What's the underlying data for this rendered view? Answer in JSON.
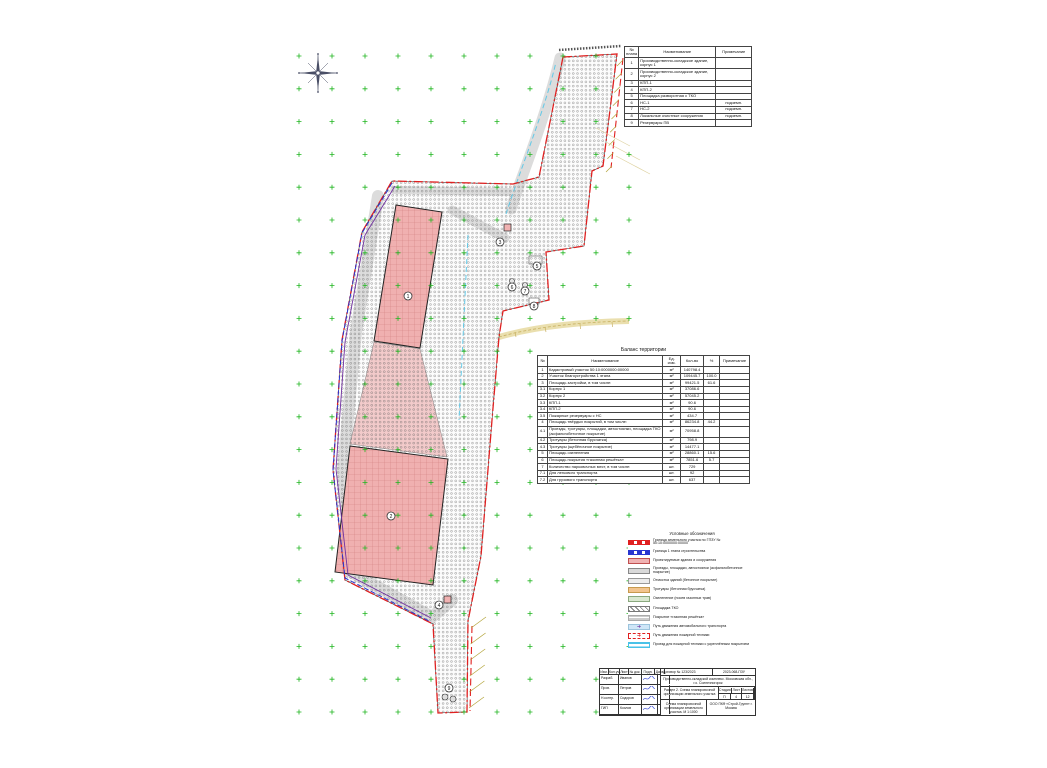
{
  "sheet": {
    "kind": "Схема планировочной организации земельного участка"
  },
  "buildings_table": {
    "headers": [
      "№ плана",
      "Наименование",
      "Примечание"
    ],
    "rows": [
      [
        "1",
        "Производственно-складское здание, корпус 1",
        ""
      ],
      [
        "2",
        "Производственно-складское здание, корпус 2",
        ""
      ],
      [
        "3",
        "КПП-1",
        ""
      ],
      [
        "4",
        "КПП-2",
        ""
      ],
      [
        "5",
        "Площадка разворотная с ТКО",
        ""
      ],
      [
        "6",
        "НС-1",
        "подземн."
      ],
      [
        "7",
        "НС-2",
        "подземн."
      ],
      [
        "8",
        "Локальные очистные сооружения",
        "подземн."
      ],
      [
        "9",
        "Резервуары ПВ",
        ""
      ]
    ]
  },
  "balance_table": {
    "title": "Баланс территории",
    "headers": [
      "№",
      "Наименование",
      "Ед. изм.",
      "Кол-во",
      "%",
      "Примечание"
    ],
    "rows": [
      [
        "1",
        "Кадастровый участок 50:10:0000000:00000",
        "м²",
        "140798.4",
        "",
        ""
      ],
      [
        "2",
        "Участок благоустройства 1 этапа",
        "м²",
        "109445.7",
        "100.0",
        ""
      ],
      [
        "3",
        "Площадь застройки, в том числе:",
        "м²",
        "99421.5",
        "61.6",
        ""
      ],
      [
        "3.1",
        "Корпус 1",
        "м²",
        "37086.6",
        "",
        ""
      ],
      [
        "3.2",
        "Корпус 2",
        "м²",
        "57045.2",
        "",
        ""
      ],
      [
        "3.3",
        "КПП-1",
        "м²",
        "90.6",
        "",
        ""
      ],
      [
        "3.4",
        "КПП-2",
        "м²",
        "90.6",
        "",
        ""
      ],
      [
        "3.5",
        "Пожарные резервуары с НС",
        "м²",
        "434.7",
        "",
        ""
      ],
      [
        "4",
        "Площадь твёрдых покрытий, в том числе:",
        "м²",
        "86234.8",
        "44.2",
        ""
      ],
      [
        "4.1",
        "Проезды, тротуары, площадки, автостоянки, площадка ТКО (асфальтобетонное покрытие)",
        "м²",
        "70958.8",
        "",
        ""
      ],
      [
        "4.2",
        "Тротуары (бетонная брусчатка)",
        "м²",
        "798.9",
        "",
        ""
      ],
      [
        "4.3",
        "Тротуары (щебёночное покрытие)",
        "м²",
        "14477.1",
        "",
        ""
      ],
      [
        "5",
        "Площадь озеленения",
        "м²",
        "28860.1",
        "15.6",
        ""
      ],
      [
        "6",
        "Площадь покрытия «газонная решётка»",
        "м²",
        "7851.6",
        "5.7",
        ""
      ],
      [
        "7",
        "Количество парковочных мест, в том числе:",
        "шт.",
        "729",
        "",
        ""
      ],
      [
        "7.1",
        "Для легкового транспорта",
        "шт.",
        "92",
        "",
        ""
      ],
      [
        "7.2",
        "Для грузового транспорта",
        "шт.",
        "637",
        "",
        ""
      ]
    ]
  },
  "legend": {
    "title": "Условные обозначения",
    "items": [
      {
        "swatch": "red-boundary",
        "label": "Граница земельного участка по ГПЗУ № 50:10:0000000:00000"
      },
      {
        "swatch": "blue-boundary",
        "label": "Граница 1 этапа строительства"
      },
      {
        "swatch": "pink",
        "label": "Проектируемые здания и сооружения"
      },
      {
        "swatch": "gray",
        "label": "Проезды, площадки, автостоянки (асфальтобетонное покрытие)"
      },
      {
        "swatch": "lightgray",
        "label": "Отмостка зданий (бетонное покрытие)"
      },
      {
        "swatch": "orange",
        "label": "Тротуары (бетонная брусчатка)"
      },
      {
        "swatch": "green",
        "label": "Озеленение (посев газонных трав)"
      },
      {
        "swatch": "hatch",
        "label": "Площадка ТКО"
      },
      {
        "swatch": "dashes",
        "label": "Покрытие «газонная решётка»"
      },
      {
        "swatch": "arrow-auto",
        "glyph": "➜",
        "glyph_color": "#7030a0",
        "label": "Путь движения автомобильного транспорта"
      },
      {
        "swatch": "arrow-fire",
        "glyph": "➜",
        "glyph_color": "#e02020",
        "label": "Путь движения пожарной техники"
      },
      {
        "swatch": "cyan",
        "label": "Проезд для пожарной техники с укреплённым покрытием"
      }
    ]
  },
  "title_block": {
    "contract": "Договор № 123/2023",
    "doc_code": "2023-068-ПЗУ",
    "project_name": "Производственно-складской комплекс. Московская обл., г.о. Солнечногорск",
    "section": "Раздел 2. Схема планировочной организации земельного участка",
    "drawing_name": "Схема планировочной организации земельного участка. М 1:1000",
    "company": "ООО ПКФ «Строй-Групп» г. Москва",
    "stage_label": "Стадия",
    "sheet_label": "Лист",
    "sheets_label": "Листов",
    "stage": "П",
    "sheet": "4",
    "sheets": "12",
    "cols": [
      "Изм.",
      "Кол.уч.",
      "Лист",
      "№ док.",
      "Подп.",
      "Дата"
    ],
    "roles": [
      {
        "role": "Разраб.",
        "name": "Иванов"
      },
      {
        "role": "Пров.",
        "name": "Петров"
      },
      {
        "role": "Н.контр.",
        "name": "Сидоров"
      },
      {
        "role": "ГИП",
        "name": "Козлов"
      }
    ]
  },
  "map": {
    "colors": {
      "boundary_red": "#e02020",
      "stage_blue": "#2936d0",
      "stage_purple": "#7030a0",
      "building_pink": "#f0b0b0",
      "cross_green": "#1fb51f",
      "fire_cyan": "#55c6e8",
      "road_yellow": "#eadfae",
      "hatch_olive": "#b3a43a"
    },
    "markers": [
      {
        "n": "1",
        "x": 408,
        "y": 296
      },
      {
        "n": "2",
        "x": 391,
        "y": 516
      },
      {
        "n": "3",
        "x": 500,
        "y": 242
      },
      {
        "n": "4",
        "x": 439,
        "y": 605
      },
      {
        "n": "5",
        "x": 537,
        "y": 266
      },
      {
        "n": "6",
        "x": 512,
        "y": 287
      },
      {
        "n": "7",
        "x": 525,
        "y": 291
      },
      {
        "n": "8",
        "x": 534,
        "y": 306
      },
      {
        "n": "9",
        "x": 449,
        "y": 688
      }
    ]
  }
}
